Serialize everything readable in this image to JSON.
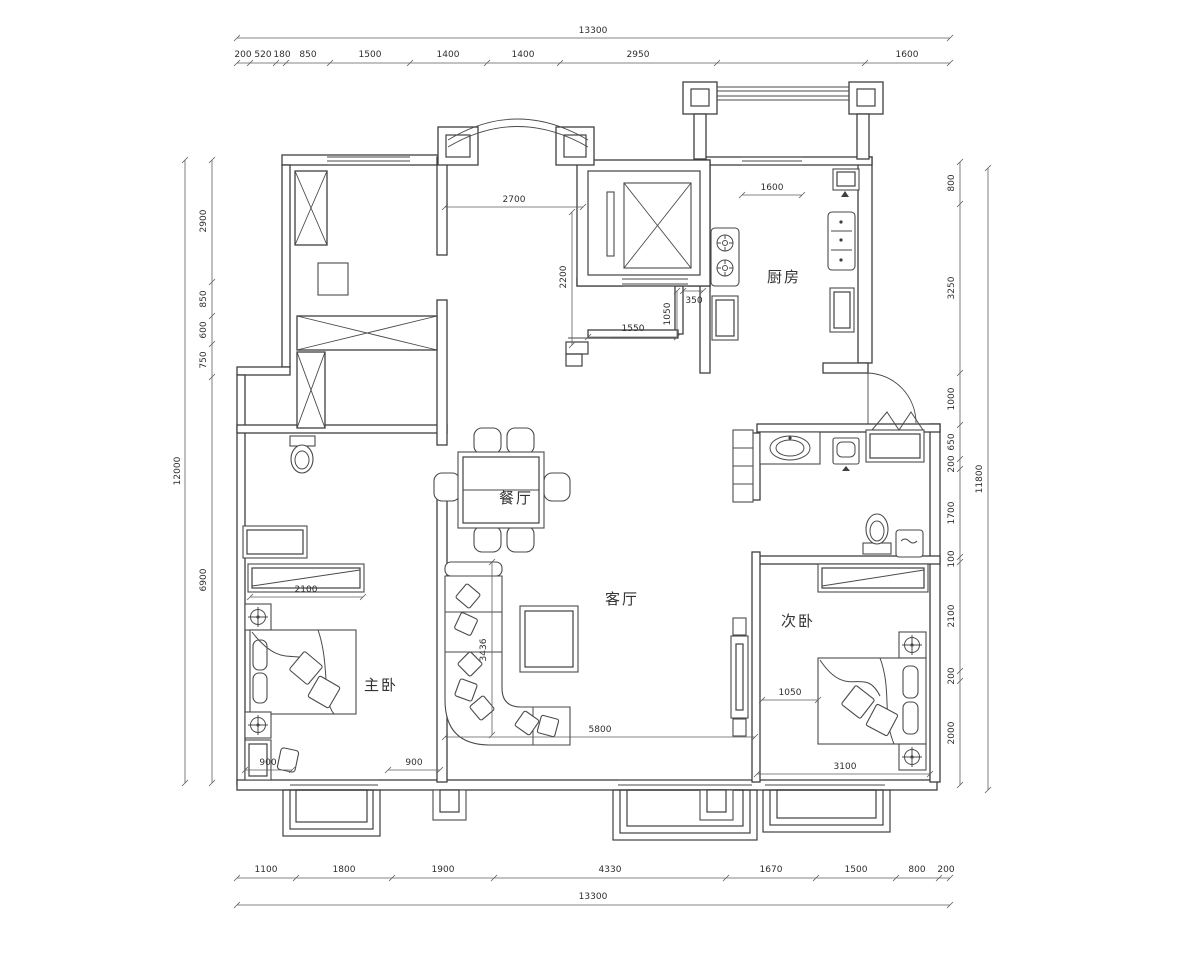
{
  "drawing": {
    "rooms": {
      "kitchen": "厨房",
      "dining": "餐厅",
      "living": "客厅",
      "master_bedroom": "主卧",
      "second_bedroom": "次卧"
    },
    "dims": {
      "top_total": "13300",
      "top": [
        "200",
        "520",
        "180",
        "850",
        "1500",
        "1400",
        "1400",
        "2950",
        "1600"
      ],
      "bottom_total": "13300",
      "bottom": [
        "1100",
        "1800",
        "1900",
        "4330",
        "1670",
        "1500",
        "800",
        "200"
      ],
      "left_total": "12000",
      "left": [
        "2900",
        "850",
        "600",
        "750",
        "6900"
      ],
      "right_total": "11800",
      "right": [
        "800",
        "3250",
        "1000",
        "650",
        "200",
        "1700",
        "100",
        "2100",
        "200",
        "2000"
      ],
      "interior": {
        "arch_width": "2700",
        "arch_depth": "2200",
        "kitchen_window": "1600",
        "entry_a": "350",
        "entry_b": "1050",
        "entry_c": "1550",
        "wardrobe": "2100",
        "living_h": "3436",
        "living_w": "5800",
        "bed_gap": "1050",
        "master_a": "900",
        "master_b": "900",
        "second_w": "3100"
      }
    },
    "colors": {
      "line": "#3f3f3f",
      "dim_line": "#5f5f5f",
      "text": "#2e2e2e",
      "background": "#ffffff"
    }
  }
}
